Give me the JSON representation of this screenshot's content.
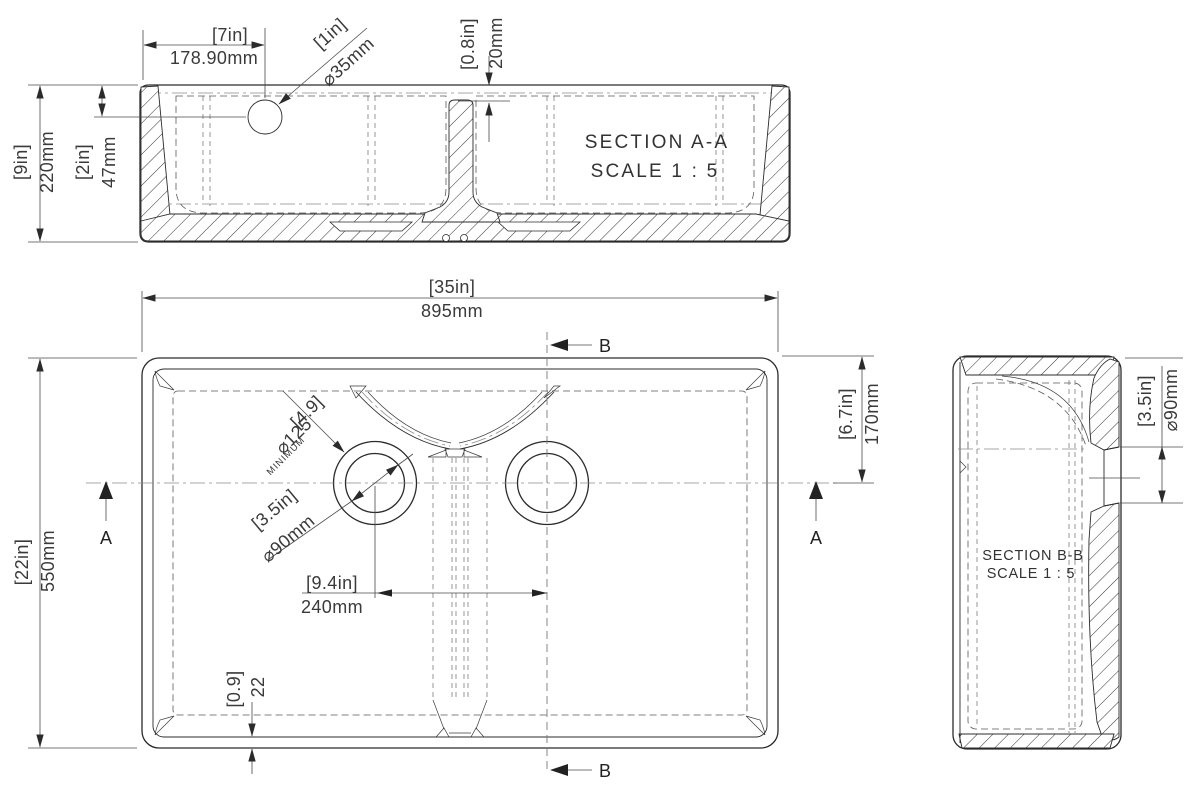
{
  "drawing": {
    "ink_color": "#2b2b2b",
    "dim_color": "#3a3a3a",
    "background": "#ffffff"
  },
  "section_aa": {
    "title": "SECTION A-A",
    "scale": "SCALE 1 : 5",
    "dim_tap_offset_in": "[7in]",
    "dim_tap_offset_mm": "178.90mm",
    "dim_tap_hole_in": "[1in]",
    "dim_tap_hole_mm": "⌀35mm",
    "dim_divider_drop_in": "[0.8in]",
    "dim_divider_drop_mm": "20mm",
    "dim_height_in": "[9in]",
    "dim_height_mm": "220mm",
    "dim_tap_depth_in": "[2in]",
    "dim_tap_depth_mm": "47mm"
  },
  "plan": {
    "dim_width_in": "[35in]",
    "dim_width_mm": "895mm",
    "dim_depth_in": "[22in]",
    "dim_depth_mm": "550mm",
    "dim_drain_offset_in": "[6.7in]",
    "dim_drain_offset_mm": "170mm",
    "dim_drain_spacing_in": "[9.4in]",
    "dim_drain_spacing_mm": "240mm",
    "dim_clearance_in": "[4.9]",
    "dim_clearance_dia": "⌀125",
    "dim_clearance_note": "MINIMUM",
    "dim_waste_in": "[3.5in]",
    "dim_waste_mm": "⌀90mm",
    "dim_wall_in": "[0.9]",
    "dim_wall_mm": "22",
    "mark_a": "A",
    "mark_b": "B"
  },
  "section_bb": {
    "title": "SECTION B-B",
    "scale": "SCALE 1 : 5",
    "dim_waste_in": "[3.5in]",
    "dim_waste_mm": "⌀90mm"
  }
}
